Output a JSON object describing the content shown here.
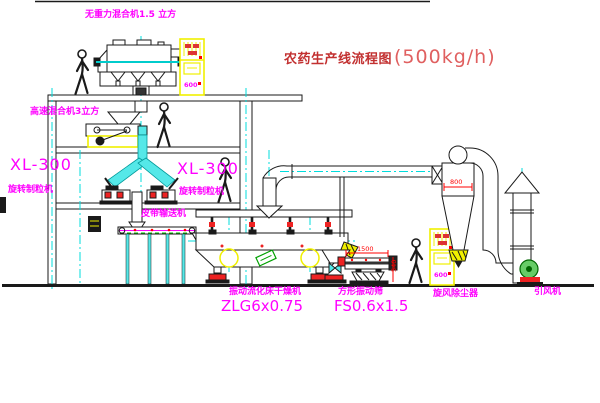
{
  "drawing": {
    "title": "农药生产线流程图",
    "title_capacity": "(500kg/h)"
  },
  "equipment_labels": {
    "gravity_mixer": "无重力混合机1.5 立方",
    "high_speed_mixer": "高速混合机3立方",
    "granulator_model": "XL-300",
    "granulator_name": "旋转制粒机",
    "granulator_model_2": "XL-300",
    "granulator_name_2": "旋转制粒机",
    "belt_conveyor": "皮带输送机",
    "dryer_name": "振动流化床干燥机",
    "dryer_model": "ZLG6x0.75",
    "screen_name": "方形振动筛",
    "screen_model": "FS0.6x1.5",
    "cyclone": "旋风除尘器",
    "induced_fan": "引风机"
  },
  "dimensions": {
    "cyclone_diameter": "800",
    "screen_length": "1500",
    "screen_height": "540"
  },
  "cabinet_readout": "600",
  "colors": {
    "label_magenta": "#ff00ff",
    "title_red": "#c23030",
    "pipe_cyan": "#55e8e8",
    "centerline_cyan": "#00dddd",
    "equipment_yellow": "#f0f000",
    "dimension_red": "#ff0000",
    "motor_green": "#00a000",
    "line_black": "#1a1a1a"
  }
}
